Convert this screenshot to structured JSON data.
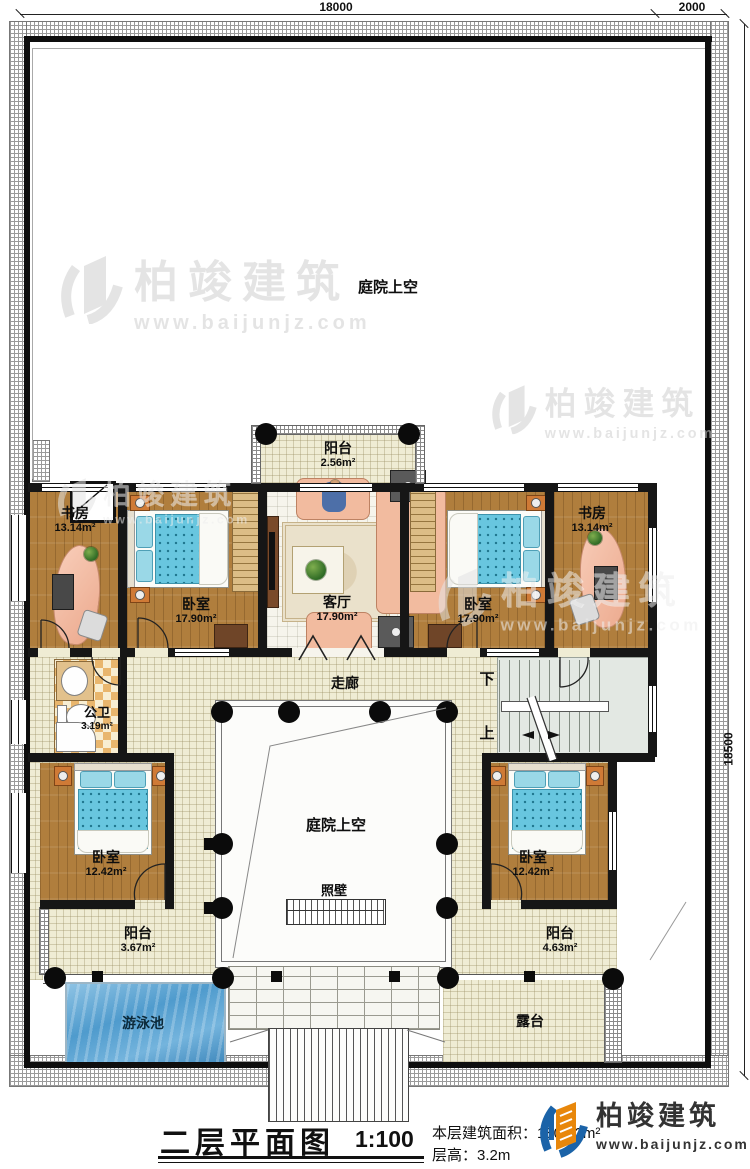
{
  "dims": {
    "top_main": "18000",
    "top_right": "2000",
    "right_side": "18500"
  },
  "rooms": {
    "study_left": {
      "name": "书房",
      "area": "13.14m²"
    },
    "bedroom_left": {
      "name": "卧室",
      "area": "17.90m²"
    },
    "living": {
      "name": "客厅",
      "area": "17.90m²"
    },
    "bedroom_right": {
      "name": "卧室",
      "area": "17.90m²"
    },
    "study_right": {
      "name": "书房",
      "area": "13.14m²"
    },
    "balcony_top": {
      "name": "阳台",
      "area": "2.56m²"
    },
    "bath": {
      "name": "公卫",
      "area": "3.19m²"
    },
    "bedroom_bl": {
      "name": "卧室",
      "area": "12.42m²"
    },
    "bedroom_br": {
      "name": "卧室",
      "area": "12.42m²"
    },
    "balcony_bl": {
      "name": "阳台",
      "area": "3.67m²"
    },
    "balcony_br": {
      "name": "阳台",
      "area": "4.63m²"
    }
  },
  "labels": {
    "courtyard_top": "庭院上空",
    "courtyard_center": "庭院上空",
    "corridor": "走廊",
    "screen_wall": "照壁",
    "down": "下",
    "up": "上",
    "pool": "游泳池",
    "terrace": "露台"
  },
  "watermark": {
    "brand": "柏竣建筑",
    "url": "www.baijunjz.com"
  },
  "title_block": {
    "title": "二层平面图",
    "scale": "1:100",
    "area_line": "本层建筑面积：180.22m²",
    "height_line": "层高：3.2m"
  },
  "logo": {
    "brand": "柏竣建筑",
    "url": "www.baijunjz.com"
  }
}
